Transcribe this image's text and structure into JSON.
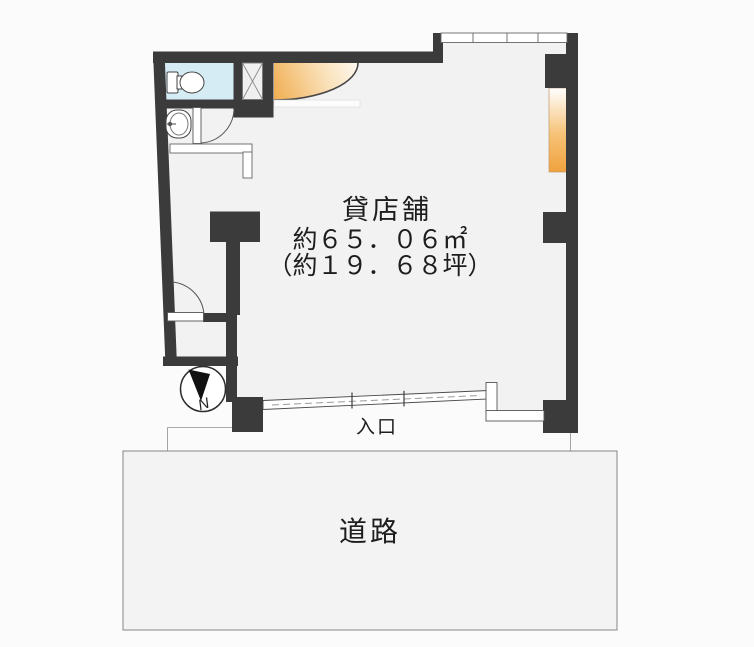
{
  "plan": {
    "property_type": "貸店舗",
    "area_sqm": "約６５．０６㎡",
    "area_tsubo": "（約１９．６８坪）",
    "entrance_label": "入口",
    "road_label": "道路",
    "north_label": "N"
  },
  "colors": {
    "wall": "#3b3b3b",
    "floor": "#f2f2f3",
    "toilet_room": "#d5ecf4",
    "window_light_strong": "#f0a23e",
    "window_light_soft": "#f3b258",
    "road_fill": "#f4f3f4",
    "road_border": "#858585",
    "background": "#fbfbfb"
  }
}
